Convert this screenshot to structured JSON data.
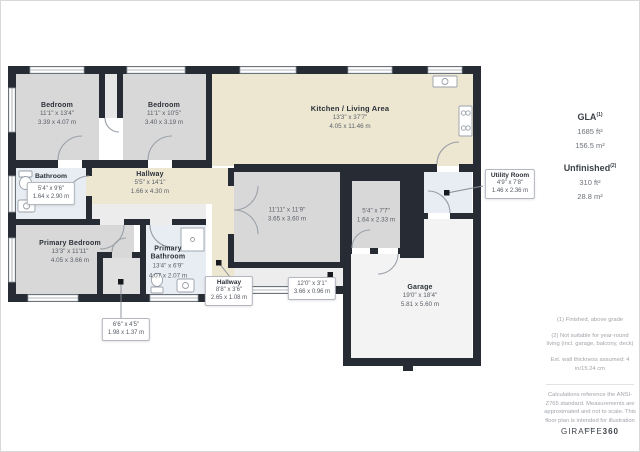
{
  "colors": {
    "wall": "#272c34",
    "kitchen_floor": "#ede7d2",
    "room_floor": "#d8d8d8",
    "wet_room_floor": "#e8edf3",
    "garage_floor": "#f3f3f3",
    "callout_border": "#b3b8bf",
    "leader_dot": "#16191d"
  },
  "rooms": [
    {
      "name": "Bedroom",
      "imperial": "11'1\" x 13'4\"",
      "metric": "3.39 x 4.07 m"
    },
    {
      "name": "Bedroom",
      "imperial": "11'1\" x 10'5\"",
      "metric": "3.40 x 3.19 m"
    },
    {
      "name": "Kitchen / Living Area",
      "imperial": "13'3\" x 37'7\"",
      "metric": "4.05 x 11.46 m"
    },
    {
      "name": "Hallway",
      "imperial": "5'5\" x 14'1\"",
      "metric": "1.66 x 4.30 m"
    },
    {
      "imperial": "11'11\" x 11'9\"",
      "metric": "3.65 x 3.60 m"
    },
    {
      "imperial": "5'4\" x 7'7\"",
      "metric": "1.64 x 2.33 m"
    },
    {
      "name": "Primary Bedroom",
      "imperial": "13'3\" x 11'11\"",
      "metric": "4.05 x 3.66 m"
    },
    {
      "name": "Primary Bathroom",
      "imperial": "13'4\" x 6'9\"",
      "metric": "4.07 x 2.07 m"
    },
    {
      "name": "Garage",
      "imperial": "19'0\" x 18'4\"",
      "metric": "5.81 x 5.60 m"
    }
  ],
  "callouts": [
    {
      "name": "Bathroom",
      "imperial": "5'4\" x 9'6\"",
      "metric": "1.64 x 2.90 m"
    },
    {
      "name": "Utility Room",
      "imperial": "4'9\" x 7'8\"",
      "metric": "1.46 x 2.36 m"
    },
    {
      "name": "Hallway",
      "imperial": "8'8\" x 3'6\"",
      "metric": "2.65 x 1.08 m"
    },
    {
      "imperial": "12'0\" x 3'1\"",
      "metric": "3.66 x 0.96 m"
    },
    {
      "imperial": "6'6\" x 4'5\"",
      "metric": "1.98 x 1.37 m"
    }
  ],
  "sidebar": {
    "gla": {
      "label": "GLA",
      "sup": "(1)",
      "sqft": "1685 ft²",
      "sqm": "156.5 m²"
    },
    "unfinished": {
      "label": "Unfinished",
      "sup": "(2)",
      "sqft": "310 ft²",
      "sqm": "28.8 m²"
    },
    "footnotes": [
      "(1) Finished, above grade",
      "(2) Not suitable for year-round living (incl. garage, balcony, deck)",
      "Ext. wall thickness assumed: 4 in/15.24 cm"
    ],
    "disclaimer": "Calculations reference the ANSI-Z765 standard. Measurements are approximated and not to scale. This floor plan is intended for illustration only.",
    "logo": {
      "brand": "GIRAFFE",
      "suffix": "360"
    }
  }
}
